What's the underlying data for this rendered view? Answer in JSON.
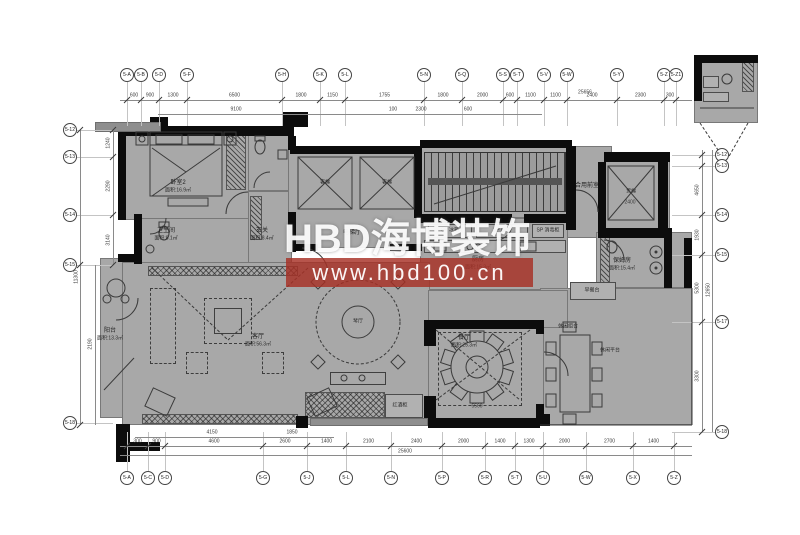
{
  "watermark": {
    "title": "HBD海博装饰",
    "url": "www.hbd100.cn",
    "band_color": "#a72f25",
    "text_color": "#ffffff"
  },
  "plan": {
    "fill_color": "#a8a8a8",
    "wall_color": "#0c0c0c"
  },
  "rooms": [
    {
      "name": "阳台",
      "area": "面积:13.3㎡"
    },
    {
      "name": "卧室2",
      "area": "面积:16.9㎡"
    },
    {
      "name": "卫生间",
      "area": "面积:8.1㎡"
    },
    {
      "name": "玄关",
      "area": "面积:8.4㎡"
    },
    {
      "name": "电梯厅",
      "area": ""
    },
    {
      "name": "合用前室",
      "area": ""
    },
    {
      "name": "保姆房",
      "area": "面积:15.4㎡"
    },
    {
      "name": "客厅",
      "area": "面积:56.3㎡"
    },
    {
      "name": "琴厅",
      "area": ""
    },
    {
      "name": "餐厅",
      "area": "面积:25.3㎡"
    },
    {
      "name": "休闲组合",
      "area": ""
    },
    {
      "name": "休闲平台",
      "area": ""
    },
    {
      "name": "早餐台",
      "area": ""
    },
    {
      "name": "红酒柜",
      "area": ""
    },
    {
      "name": "厨房",
      "area": "面积:15.3㎡"
    }
  ],
  "appliances": [
    "SP 冰箱",
    "SP 橱柜",
    "SP 消毒柜"
  ],
  "elevators": [
    "客梯",
    "客梯",
    "货梯"
  ],
  "grid": {
    "top": [
      "5-A",
      "5-B",
      "5-D",
      "5-F",
      "5-H",
      "5-K",
      "5-L",
      "5-N",
      "5-Q",
      "5-S",
      "5-T",
      "5-V",
      "5-W",
      "5-Y",
      "5-Z",
      "5-Z1"
    ],
    "bottom": [
      "5-A",
      "5-C",
      "5-D",
      "5-G",
      "5-J",
      "5-L",
      "5-N",
      "5-P",
      "5-R",
      "5-T",
      "5-U",
      "5-W",
      "5-X",
      "5-Z"
    ],
    "left": [
      "5-12",
      "5-13",
      "5-14",
      "5-15",
      "5-18"
    ],
    "right": [
      "5-12",
      "5-13",
      "5-14",
      "5-15",
      "5-17",
      "5-18"
    ]
  },
  "dims": {
    "top_row": [
      "600",
      "900",
      "1300",
      "6500",
      "1800",
      "1150",
      "1755",
      "1800",
      "2000",
      "600",
      "1100",
      "1100",
      "2400",
      "2300",
      "300"
    ],
    "top_inner": [
      "9100",
      "100",
      "2300",
      "600"
    ],
    "top_overall": "25656",
    "bottom_row": [
      "300",
      "900",
      "4600",
      "2600",
      "1400",
      "2100",
      "2400",
      "2000",
      "1400",
      "1300",
      "2000",
      "2700",
      "1400"
    ],
    "bottom_inner": [
      "4150",
      "1850"
    ],
    "bottom_overall": "25600",
    "left_row": [
      "1240",
      "2290",
      "3140"
    ],
    "left_balcony": "2190",
    "left_overall": "11300",
    "right_row": [
      "4650",
      "1930",
      "5300",
      "3300"
    ],
    "right_overall": "12650",
    "elev_dim": "2400",
    "table_dim": "5560"
  }
}
